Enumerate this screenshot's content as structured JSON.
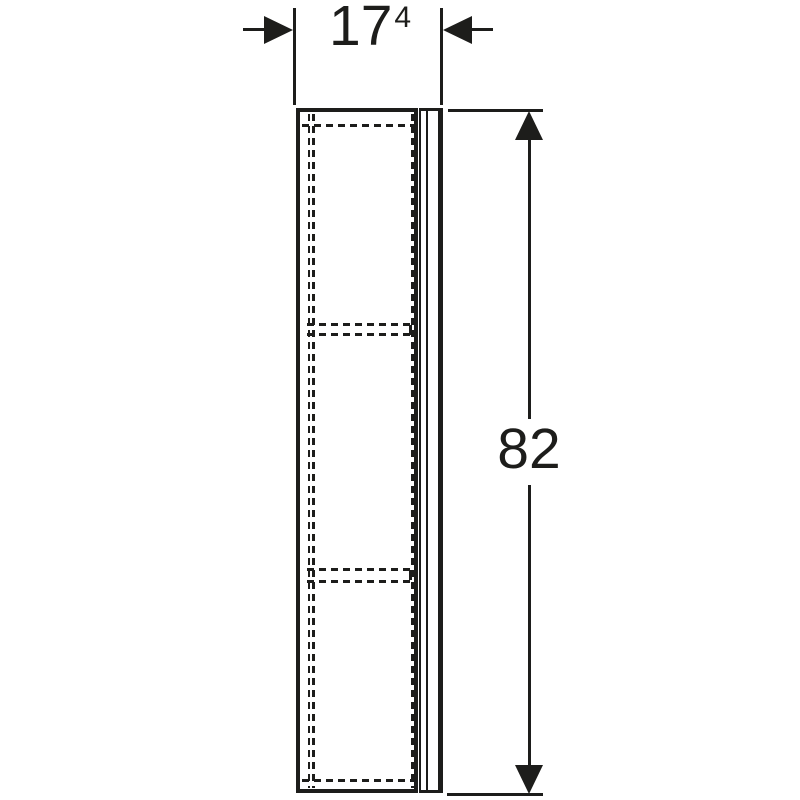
{
  "drawing": {
    "subject": "tall cabinet side elevation with one door and two hidden shelves",
    "view": "side elevation technical drawing",
    "width_dimension": {
      "value": "17",
      "superscript": "4"
    },
    "height_dimension": {
      "value": "82"
    },
    "colors": {
      "line": "#1d1d1b",
      "background": "#ffffff"
    }
  }
}
